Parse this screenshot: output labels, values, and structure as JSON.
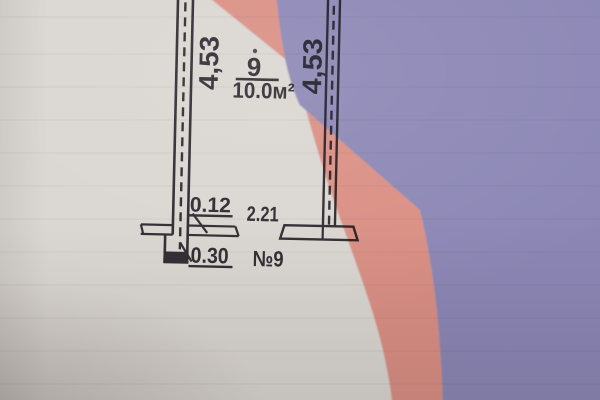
{
  "labels": {
    "left_wall_length": "4,53",
    "right_wall_length": "4,53",
    "room_number": "9",
    "room_area": "10.0м²",
    "partition_thickness": "0.12",
    "opening_width": "2.21",
    "outer_wall_thickness": "0.30",
    "room_tag": "№9"
  },
  "colors": {
    "paper": "#dad6d1",
    "ink": "#2e2b30",
    "pink_region_observed": "#eb9187",
    "purple_region_observed": "#8d88b6",
    "pink_multiply_fill": "#ffaba1",
    "purple_multiply_fill": "#a4a1dd"
  }
}
